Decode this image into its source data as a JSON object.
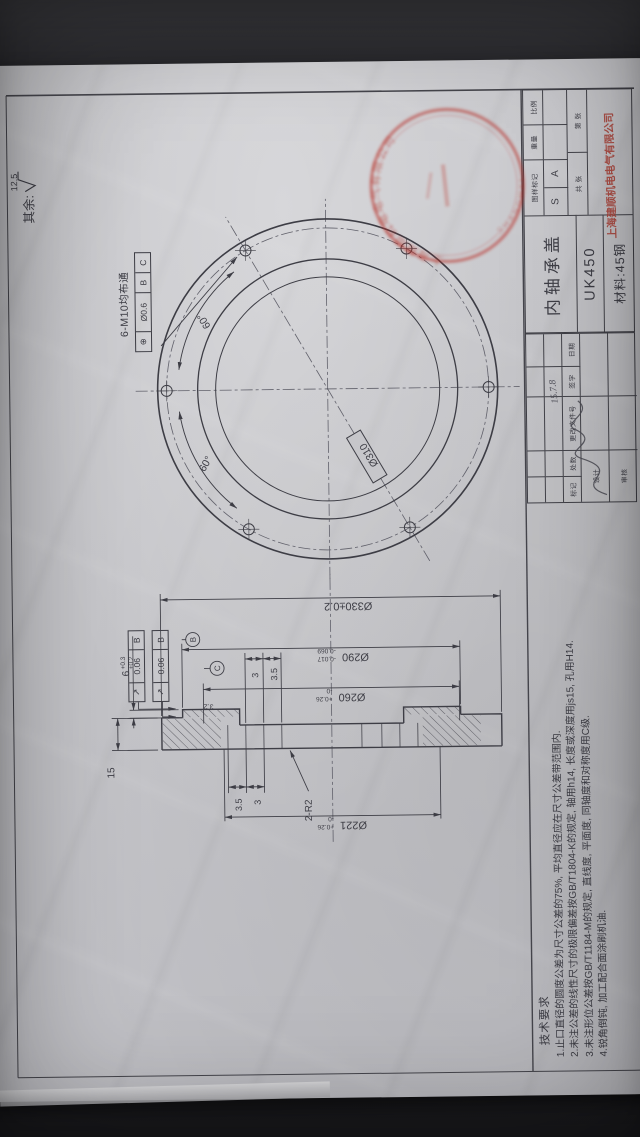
{
  "surface_note": {
    "prefix": "其余:",
    "value": "12.5"
  },
  "front_view": {
    "bolt_note": "6-M10均布通",
    "position_frame": {
      "symbol": "⊕",
      "tolerance": "Ø0.6",
      "datum_b": "B",
      "datum_c": "C"
    },
    "bolt_circle_dia": "Ø310",
    "angle_right": "60°",
    "angle_left": "60°"
  },
  "section_view": {
    "dia_330": "Ø330±0.2",
    "dia_290": {
      "main": "Ø290",
      "sup": "-0.017",
      "sub": "-0.069"
    },
    "dia_260": {
      "main": "Ø260",
      "sup": "+0.26",
      "sub": "-0"
    },
    "dia_221": {
      "main": "Ø221",
      "sup": "+0.26",
      "sub": "-0"
    },
    "step_6": {
      "main": "6",
      "sup": "+0.3",
      "sub": "+0.2"
    },
    "thickness": "15",
    "fillet": "2-R2",
    "groove_right_1": "3",
    "groove_right_2": "3.5",
    "groove_left_1": "3.5",
    "groove_left_2": "3",
    "runout_frame_1": {
      "symbol": "↗",
      "tolerance": "0.06",
      "datum": "B"
    },
    "runout_frame_2": {
      "symbol": "↗",
      "tolerance": "0.06",
      "datum": "B"
    },
    "finish": "3.2",
    "datum_b": "B",
    "datum_c": "C"
  },
  "tech_requirements": {
    "title": "技术要求",
    "items": [
      "1.止口直径的圆度公差为尺寸公差的75%, 平均直径应在尺寸公差带范围内.",
      "2.未注公差的线性尺寸的极限偏差按GB/T1804-K的规定, 轴用h14, 长度或深度用js15, 孔用H14.",
      "3.未注形位公差按GB/T1184-M的规定, 直线度, 平面度, 同轴度和对称度用C级.",
      "4.锐角倒钝, 加工配合面涂刷机油."
    ]
  },
  "title_block": {
    "part_name": "内轴承盖",
    "model": "UK450",
    "material": "材料:45钢",
    "company": "上海建顺机电电气有限公司",
    "mark_label": "图样标记",
    "weight_label": "重量",
    "scale_label": "比例",
    "mark_s": "S",
    "mark_a": "A",
    "sheet_label": "共 张",
    "page_label": "第 张"
  },
  "revision_block": {
    "mark": "标记",
    "count": "处数",
    "doc_no": "更改文件号",
    "sign": "签字",
    "date": "日期",
    "design": "设计",
    "check": "审核",
    "date_value": "15.7.8"
  },
  "stamp": {
    "arc_top": "上海建顺机电电气有限公司",
    "arc_bottom": "SHANGHAI"
  },
  "colors": {
    "paper": "#c6c6ca",
    "line": "#3d3d45",
    "red": "#b0463c"
  }
}
